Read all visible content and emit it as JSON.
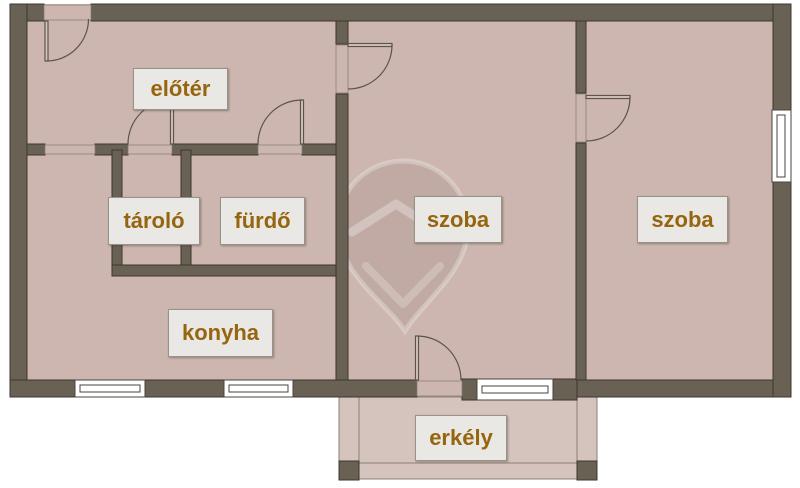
{
  "document_type": "apartment floor plan",
  "rooms": {
    "elotere": {
      "label": "előtér"
    },
    "tarolo": {
      "label": "tároló"
    },
    "furdo": {
      "label": "fürdő"
    },
    "konyha": {
      "label": "konyha"
    },
    "szoba_left": {
      "label": "szoba"
    },
    "szoba_right": {
      "label": "szoba"
    },
    "erkely": {
      "label": "erkély"
    }
  },
  "colors": {
    "wall": "#6a6155",
    "wall_outline": "#3b362f",
    "floor": "#ccb6af",
    "balcony_floor": "#d5c3bd",
    "window": "#ffffff",
    "label_background": "#eae8e4",
    "label_text": "#96650f",
    "background": "#ffffff"
  }
}
